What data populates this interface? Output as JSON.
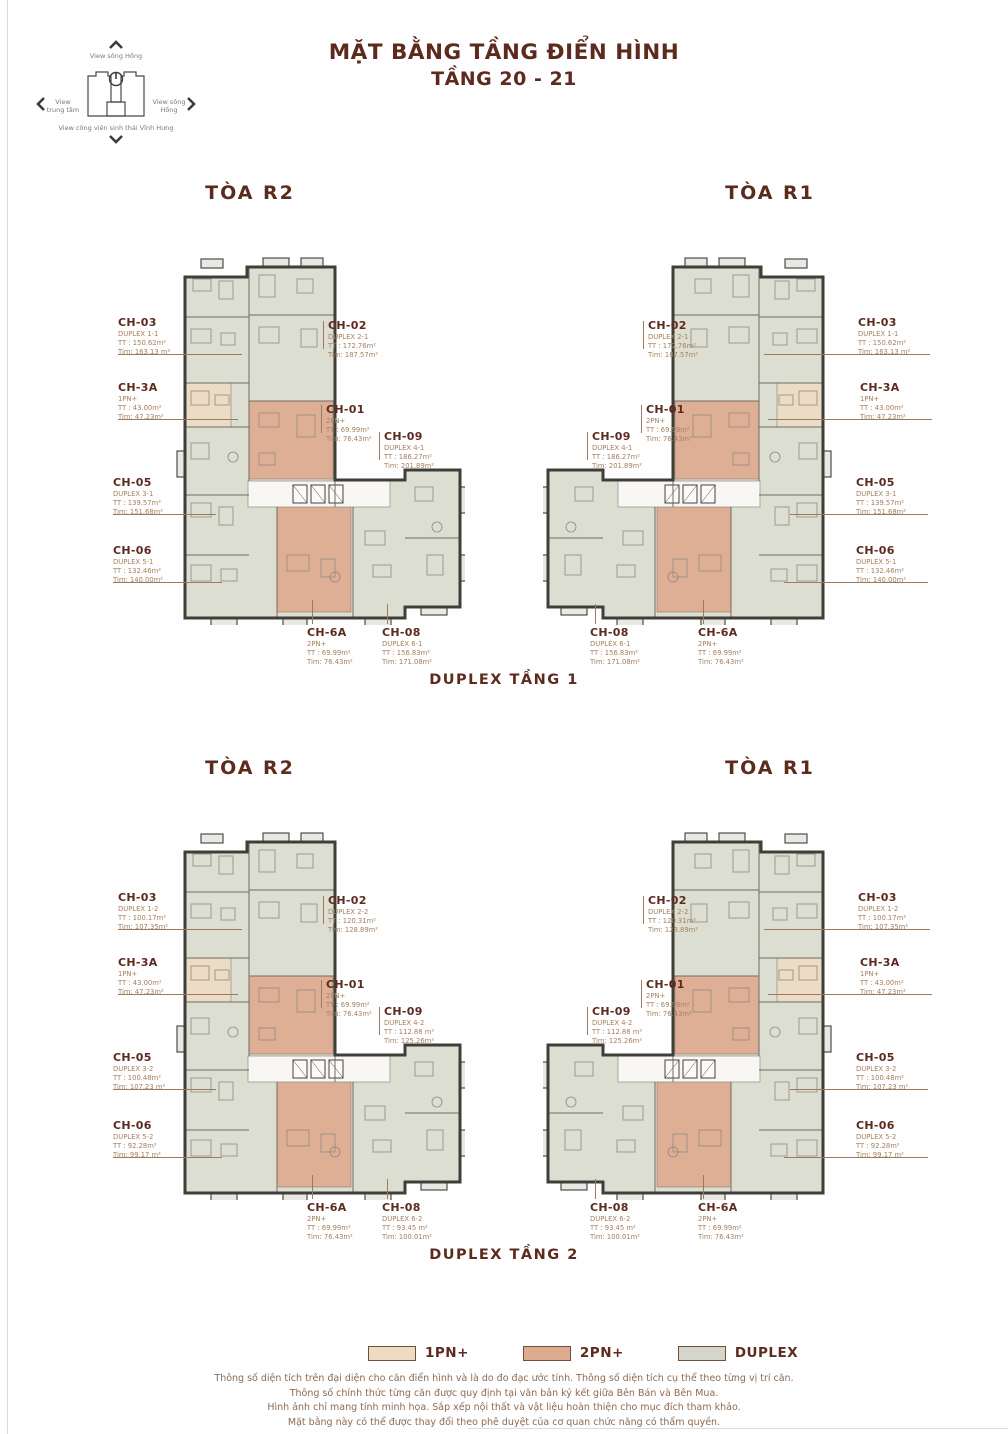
{
  "page": {
    "title_line1": "MẶT BẰNG TẦNG ĐIỂN HÌNH",
    "title_line2": "TẦNG 20 - 21"
  },
  "compass": {
    "top": "View sông Hồng",
    "left": "View trung tâm",
    "right": "View sông Hồng",
    "bottom": "View công viên sinh thái Vĩnh Hưng"
  },
  "sections": [
    {
      "caption": "DUPLEX TẦNG 1",
      "tower_left": "TÒA R2",
      "tower_right": "TÒA R1",
      "units": [
        {
          "code": "CH-03",
          "type": "DUPLEX 1-1",
          "tt": "TT : 150.62m²",
          "tim": "Tim: 163.13 m²"
        },
        {
          "code": "CH-3A",
          "type": "1PN+",
          "tt": "TT : 43.00m²",
          "tim": "Tim: 47.23m²"
        },
        {
          "code": "CH-05",
          "type": "DUPLEX 3-1",
          "tt": "TT : 139.57m²",
          "tim": "Tim: 151.68m²"
        },
        {
          "code": "CH-06",
          "type": "DUPLEX 5-1",
          "tt": "TT : 132.46m²",
          "tim": "Tim: 140.00m²"
        },
        {
          "code": "CH-02",
          "type": "DUPLEX 2-1",
          "tt": "TT : 172.76m²",
          "tim": "Tim: 187.57m²"
        },
        {
          "code": "CH-01",
          "type": "2PN+",
          "tt": "TT : 69.99m²",
          "tim": "Tim: 76.43m²"
        },
        {
          "code": "CH-09",
          "type": "DUPLEX 4-1",
          "tt": "TT : 186.27m²",
          "tim": "Tim: 201.89m²"
        },
        {
          "code": "CH-6A",
          "type": "2PN+",
          "tt": "TT : 69.99m²",
          "tim": "Tim: 76.43m²"
        },
        {
          "code": "CH-08",
          "type": "DUPLEX 6-1",
          "tt": "TT : 156.83m²",
          "tim": "Tim: 171.08m²"
        }
      ]
    },
    {
      "caption": "DUPLEX TẦNG 2",
      "tower_left": "TÒA R2",
      "tower_right": "TÒA R1",
      "units": [
        {
          "code": "CH-03",
          "type": "DUPLEX 1-2",
          "tt": "TT : 100.17m²",
          "tim": "Tim: 107.35m²"
        },
        {
          "code": "CH-3A",
          "type": "1PN+",
          "tt": "TT : 43.00m²",
          "tim": "Tim: 47.23m²"
        },
        {
          "code": "CH-05",
          "type": "DUPLEX 3-2",
          "tt": "TT : 100.48m²",
          "tim": "Tim: 107.23 m²"
        },
        {
          "code": "CH-06",
          "type": "DUPLEX 5-2",
          "tt": "TT : 92.28m²",
          "tim": "Tim: 99.17 m²"
        },
        {
          "code": "CH-02",
          "type": "DUPLEX 2-2",
          "tt": "TT : 120.31m²",
          "tim": "Tim: 128.89m²"
        },
        {
          "code": "CH-01",
          "type": "2PN+",
          "tt": "TT : 69.99m²",
          "tim": "Tim: 76.43m²"
        },
        {
          "code": "CH-09",
          "type": "DUPLEX 4-2",
          "tt": "TT : 112.88 m²",
          "tim": "Tim: 125.26m²"
        },
        {
          "code": "CH-6A",
          "type": "2PN+",
          "tt": "TT : 69.99m²",
          "tim": "Tim: 76.43m²"
        },
        {
          "code": "CH-08",
          "type": "DUPLEX 6-2",
          "tt": "TT : 93.45 m²",
          "tim": "Tim: 100.01m²"
        }
      ]
    }
  ],
  "legend": [
    {
      "label": "1PN+",
      "color": "#eddcc3"
    },
    {
      "label": "2PN+",
      "color": "#dcab90"
    },
    {
      "label": "DUPLEX",
      "color": "#d4d6ca"
    }
  ],
  "footer": [
    "Thông số diện tích trên đại diện cho căn điển hình và là do đo đạc ước tính. Thông số diện tích cụ thể theo từng vị trí căn.",
    "Thông số chính thức từng căn được quy định tại văn bản ký kết giữa Bên Bán và Bên Mua.",
    "Hình ảnh chỉ mang tính minh họa. Sắp xếp nội thất và vật liệu hoàn thiện cho mục đích tham khảo.",
    "Mặt bằng này có thể được thay đổi theo phê duyệt của cơ quan chức năng có thẩm quyền."
  ]
}
